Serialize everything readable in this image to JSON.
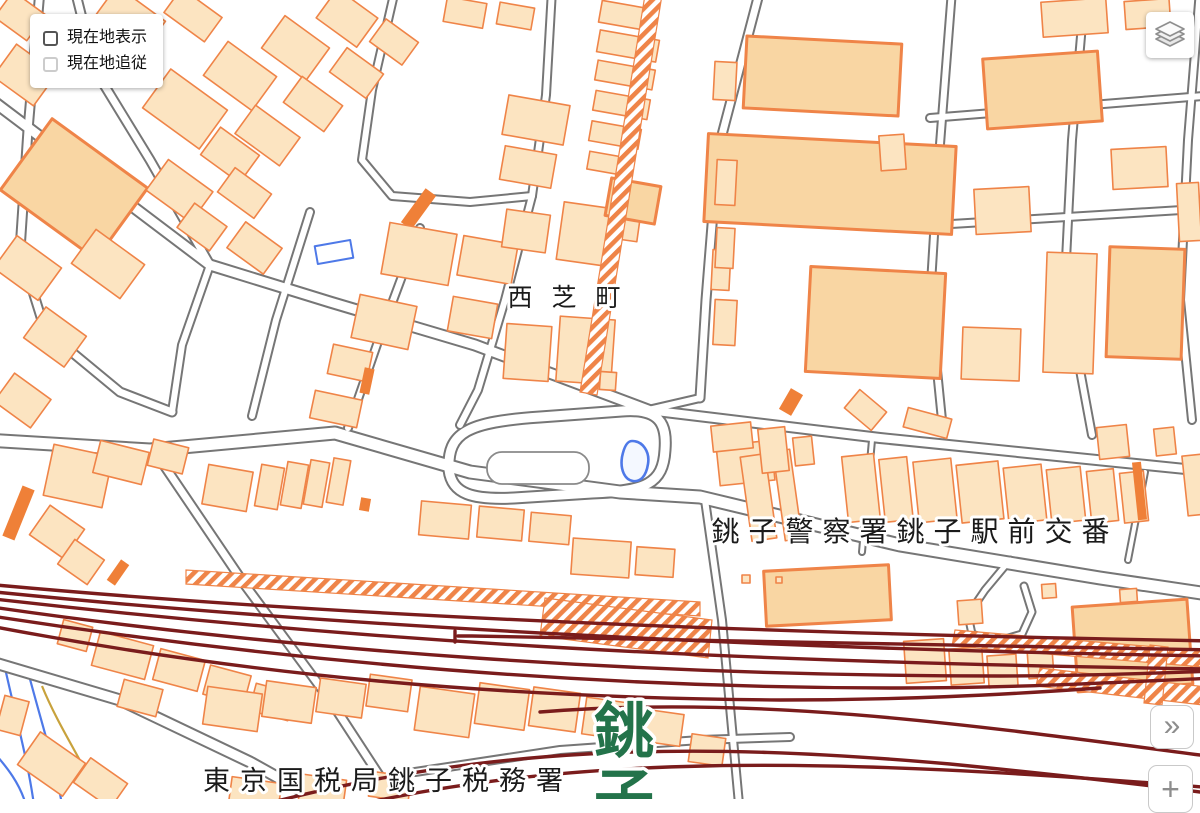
{
  "ui": {
    "location_panel": {
      "options": [
        {
          "label": "現在地表示",
          "checked": false,
          "disabled": false
        },
        {
          "label": "現在地追従",
          "checked": false,
          "disabled": true
        }
      ]
    },
    "layers_button": {
      "icon": "layers-icon"
    },
    "collapse_button": {
      "glyph": "»"
    },
    "zoom_in_button": {
      "glyph": "+"
    }
  },
  "map": {
    "labels": [
      {
        "name": "town-label-nishi-shiba-cho",
        "text": "西 芝 町",
        "x": 567,
        "y": 306,
        "size": 25,
        "spacing": 6,
        "color": "#1a1a1a",
        "weight": 500,
        "halo_width": 6
      },
      {
        "name": "poi-label-choshi-police-box",
        "text": "銚子警察署銚子駅前交番",
        "x": 915,
        "y": 541,
        "size": 28,
        "spacing": 9,
        "color": "#1a1a1a",
        "weight": 500,
        "halo_width": 6
      },
      {
        "name": "poi-label-tokyo-tax-office",
        "text": "東京国税局銚子税務署",
        "x": 388,
        "y": 790,
        "size": 27,
        "spacing": 10,
        "color": "#1a1a1a",
        "weight": 500,
        "halo_width": 6
      },
      {
        "name": "station-label-choshi",
        "text": "銚子",
        "x": 624,
        "y": 752,
        "size": 60,
        "spacing": 0,
        "color": "#23734a",
        "weight": 700,
        "halo_width": 7,
        "vertical": true,
        "line_height": 66
      }
    ],
    "style": {
      "background": "#ffffff",
      "building_fill": "#fce4c1",
      "building_fill_major": "#f9d6a3",
      "building_stroke": "#ef8448",
      "building_solid": "#ef8038",
      "building_outline_blue": "#4e79e8",
      "road_casing": "#767676",
      "road_fill": "#ffffff",
      "railway": "#7a1c1c",
      "water_line": "#4e79e8",
      "contour_line": "#c8a23c",
      "pond_fill": "#f4f8ff",
      "halo": "#ffffff"
    }
  }
}
